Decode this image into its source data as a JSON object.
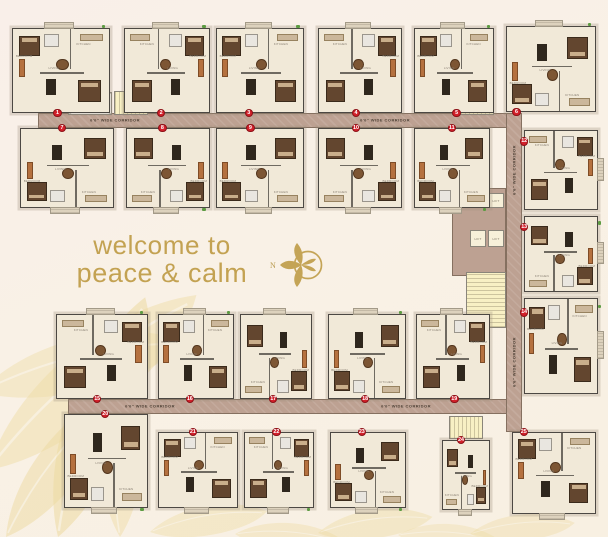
{
  "page": {
    "tagline_line1": "welcome to",
    "tagline_line2": "peace & calm",
    "north_label": "N",
    "accent_gold": "#c3a252",
    "background": "#f8f0e6",
    "corridor_color": "#bda192",
    "badge_color": "#d2202a"
  },
  "rooms": {
    "bedroom": "BEDROOM",
    "living": "LIVING",
    "kitchen": "KITCHEN",
    "lift": "LIFT"
  },
  "plan": {
    "corridor_label": "6'6\" WIDE CORRIDOR",
    "corridors": [
      {
        "x": 38,
        "y": 113,
        "w": 484,
        "h": 15,
        "vert": false,
        "labels": [
          {
            "x": 115,
            "y": 120
          },
          {
            "x": 385,
            "y": 120
          }
        ]
      },
      {
        "x": 68,
        "y": 399,
        "w": 454,
        "h": 15,
        "vert": false,
        "labels": [
          {
            "x": 150,
            "y": 406
          },
          {
            "x": 406,
            "y": 406
          }
        ]
      },
      {
        "x": 506,
        "y": 113,
        "w": 16,
        "h": 319,
        "vert": true,
        "labels": [
          {
            "x": 514,
            "y": 170
          },
          {
            "x": 514,
            "y": 362
          }
        ]
      }
    ],
    "cores": [
      {
        "t": "shaft",
        "x": 68,
        "y": 92,
        "w": 44,
        "h": 23
      },
      {
        "t": "stairs",
        "x": 114,
        "y": 91,
        "w": 34,
        "h": 24,
        "dir": "v"
      },
      {
        "t": "stairs",
        "x": 452,
        "y": 89,
        "w": 42,
        "h": 26,
        "dir": "v"
      },
      {
        "t": "lobby",
        "x": 452,
        "y": 188,
        "w": 54,
        "h": 88
      },
      {
        "t": "lift",
        "x": 470,
        "y": 193,
        "w": 16,
        "h": 15
      },
      {
        "t": "lift",
        "x": 488,
        "y": 193,
        "w": 16,
        "h": 15
      },
      {
        "t": "lift",
        "x": 470,
        "y": 230,
        "w": 16,
        "h": 17
      },
      {
        "t": "lift",
        "x": 488,
        "y": 230,
        "w": 16,
        "h": 17
      },
      {
        "t": "stairs",
        "x": 466,
        "y": 272,
        "w": 40,
        "h": 56,
        "dir": "h"
      },
      {
        "t": "stairs",
        "x": 449,
        "y": 416,
        "w": 34,
        "h": 23,
        "dir": "v"
      }
    ],
    "units": [
      {
        "n": "1",
        "x": 12,
        "y": 28,
        "w": 98,
        "h": 85,
        "b": "bottom",
        "o": 42,
        "v": 0,
        "g": 1
      },
      {
        "n": "2",
        "x": 124,
        "y": 28,
        "w": 86,
        "h": 85,
        "b": "bottom",
        "o": 38,
        "v": 1,
        "g": 1
      },
      {
        "n": "3",
        "x": 216,
        "y": 28,
        "w": 88,
        "h": 85,
        "b": "bottom",
        "o": 32,
        "v": 0,
        "g": 1
      },
      {
        "n": "4",
        "x": 318,
        "y": 28,
        "w": 84,
        "h": 85,
        "b": "bottom",
        "o": 40,
        "v": 1,
        "g": 0
      },
      {
        "n": "5",
        "x": 414,
        "y": 28,
        "w": 80,
        "h": 85,
        "b": "bottom",
        "o": 48,
        "v": 0,
        "g": 1
      },
      {
        "n": "6",
        "x": 506,
        "y": 26,
        "w": 90,
        "h": 86,
        "b": "bottom",
        "o": 6,
        "v": 2,
        "g": 1
      },
      {
        "n": "7",
        "x": 20,
        "y": 128,
        "w": 94,
        "h": 80,
        "b": "top",
        "o": 40,
        "v": 2,
        "g": 0
      },
      {
        "n": "8",
        "x": 126,
        "y": 128,
        "w": 84,
        "h": 80,
        "b": "top",
        "o": 38,
        "v": 3,
        "g": 1
      },
      {
        "n": "9",
        "x": 216,
        "y": 128,
        "w": 88,
        "h": 80,
        "b": "top",
        "o": 34,
        "v": 2,
        "g": 0
      },
      {
        "n": "10",
        "x": 318,
        "y": 128,
        "w": 84,
        "h": 80,
        "b": "top",
        "o": 40,
        "v": 3,
        "g": 0
      },
      {
        "n": "11",
        "x": 414,
        "y": 128,
        "w": 76,
        "h": 80,
        "b": "top",
        "o": 44,
        "v": 2,
        "g": 1
      },
      {
        "n": "12",
        "x": 524,
        "y": 130,
        "w": 74,
        "h": 80,
        "b": "left",
        "o": 8,
        "v": 1,
        "g": 0
      },
      {
        "n": "13",
        "x": 524,
        "y": 216,
        "w": 74,
        "h": 76,
        "b": "left",
        "o": 8,
        "v": 3,
        "g": 1
      },
      {
        "n": "14",
        "x": 524,
        "y": 298,
        "w": 74,
        "h": 96,
        "b": "left",
        "o": 10,
        "v": 0,
        "g": 1
      },
      {
        "n": "15",
        "x": 56,
        "y": 314,
        "w": 92,
        "h": 85,
        "b": "bottom",
        "o": 40,
        "v": 1,
        "g": 1
      },
      {
        "n": "16",
        "x": 158,
        "y": 314,
        "w": 76,
        "h": 85,
        "b": "bottom",
        "o": 36,
        "v": 0,
        "g": 1
      },
      {
        "n": "17",
        "x": 240,
        "y": 314,
        "w": 72,
        "h": 85,
        "b": "bottom",
        "o": 40,
        "v": 3,
        "g": 0
      },
      {
        "n": "18",
        "x": 328,
        "y": 314,
        "w": 78,
        "h": 85,
        "b": "bottom",
        "o": 42,
        "v": 2,
        "g": 1
      },
      {
        "n": "19",
        "x": 416,
        "y": 314,
        "w": 74,
        "h": 85,
        "b": "bottom",
        "o": 46,
        "v": 1,
        "g": 0
      },
      {
        "n": "20",
        "x": 64,
        "y": 414,
        "w": 84,
        "h": 94,
        "b": "top",
        "o": 44,
        "v": 2,
        "g": 1
      },
      {
        "n": "21",
        "x": 158,
        "y": 432,
        "w": 80,
        "h": 76,
        "b": "top",
        "o": 38,
        "v": 0,
        "g": 0
      },
      {
        "n": "22",
        "x": 244,
        "y": 432,
        "w": 70,
        "h": 76,
        "b": "top",
        "o": 40,
        "v": 1,
        "g": 1
      },
      {
        "n": "23",
        "x": 330,
        "y": 432,
        "w": 76,
        "h": 76,
        "b": "top",
        "o": 36,
        "v": 2,
        "g": 1
      },
      {
        "n": "24",
        "x": 442,
        "y": 440,
        "w": 48,
        "h": 70,
        "b": "top",
        "o": 30,
        "v": 3,
        "g": 0
      },
      {
        "n": "25",
        "x": 512,
        "y": 432,
        "w": 84,
        "h": 82,
        "b": "top",
        "o": 8,
        "v": 0,
        "g": 0
      }
    ]
  }
}
